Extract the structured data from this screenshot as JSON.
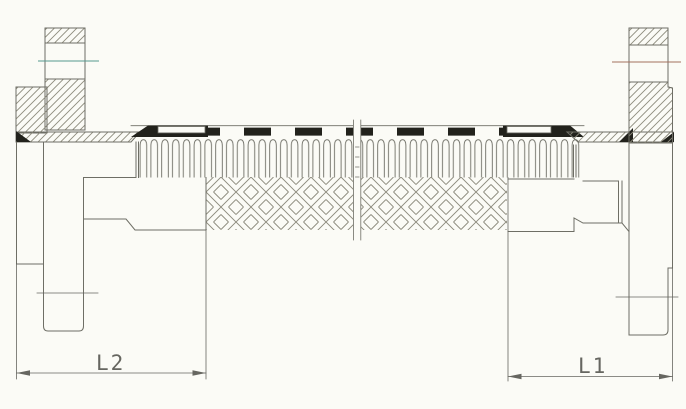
{
  "labels": {
    "dim_left": "L2",
    "dim_right": "L1"
  },
  "colors": {
    "background": "#fbfbf6",
    "line": "#6e6e65",
    "hatch": "#8d8b7d",
    "dark": "#22221c",
    "dim": "#666660",
    "centerline_left": "#55988f",
    "centerline_right": "#a3705f"
  }
}
